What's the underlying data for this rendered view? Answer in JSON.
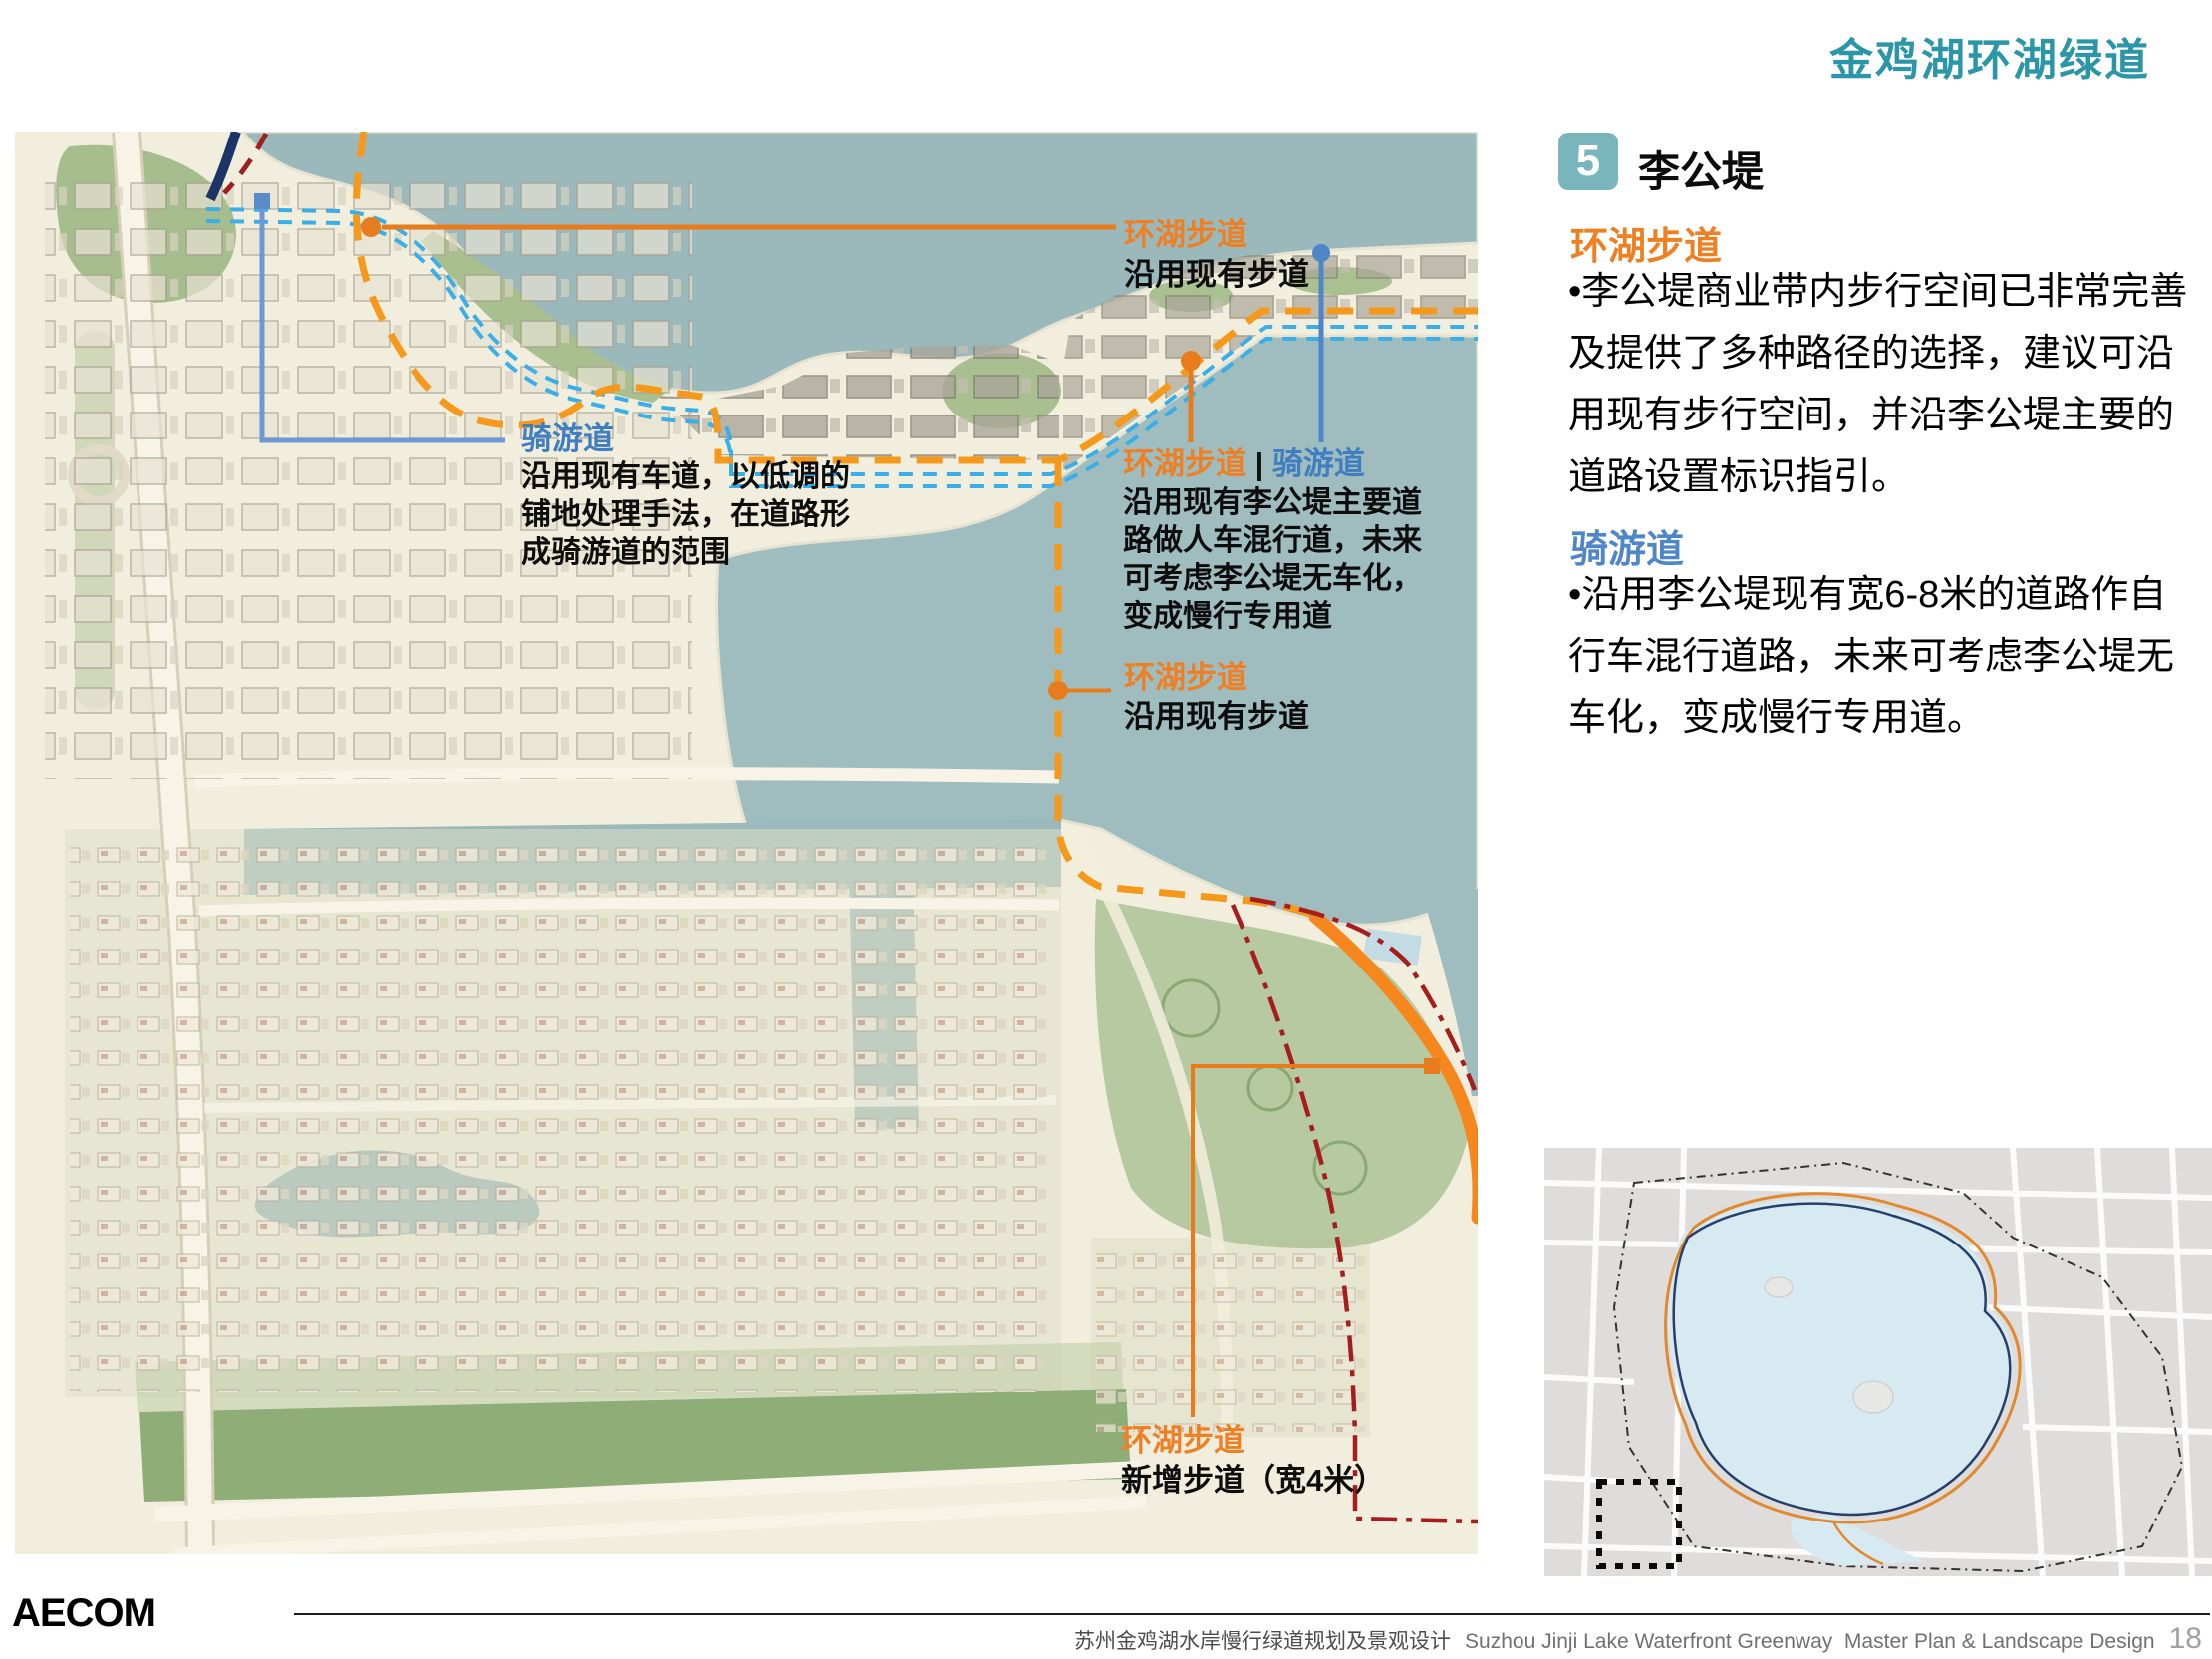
{
  "page": {
    "title": "金鸡湖环湖绿道"
  },
  "panel": {
    "number": "5",
    "heading": "李公堤",
    "sections": [
      {
        "title": "环湖步道",
        "lines": [
          "•李公堤商业带内步行空间已非常完善",
          "及提供了多种路径的选择，建议可沿",
          "用现有步行空间，并沿李公堤主要的",
          "道路设置标识指引。"
        ]
      },
      {
        "title": "骑游道",
        "lines": [
          "•沿用李公堤现有宽6-8米的道路作自",
          "行车混行道路，未来可考虑李公堤无",
          "车化，变成慢行专用道。"
        ]
      }
    ]
  },
  "map": {
    "annotations": [
      {
        "title": "环湖步道",
        "lines": [
          "沿用现有步道"
        ]
      },
      {
        "title": "骑游道",
        "lines": [
          "沿用现有车道，以低调的",
          "铺地处理手法，在道路形",
          "成骑游道的范围"
        ]
      },
      {
        "title_walk": "环湖步道",
        "title_sep": " | ",
        "title_bike": "骑游道",
        "lines": [
          "沿用现有李公堤主要道",
          "路做人车混行道，未来",
          "可考虑李公堤无车化，",
          "变成慢行专用道"
        ]
      },
      {
        "title": "环湖步道",
        "lines": [
          "沿用现有步道"
        ]
      },
      {
        "title": "环湖步道",
        "lines": [
          "新增步道（宽4米）"
        ]
      }
    ]
  },
  "colors": {
    "accent_teal": "#2a96a7",
    "walkway_orange": "#f5991c",
    "bikeway_cyan": "#3aaee6",
    "bike_label_blue": "#3f7fc1",
    "existing_route_navy": "#1d3566",
    "boundary_dark_red": "#a51d1d",
    "new_path_orange": "#f6871f"
  },
  "footer": {
    "logo": "AECOM",
    "title_zh": "苏州金鸡湖水岸慢行绿道规划及景观设计",
    "title_en": "Suzhou Jinji Lake Waterfront Greenway  Master Plan & Landscape Design",
    "page": "18"
  }
}
